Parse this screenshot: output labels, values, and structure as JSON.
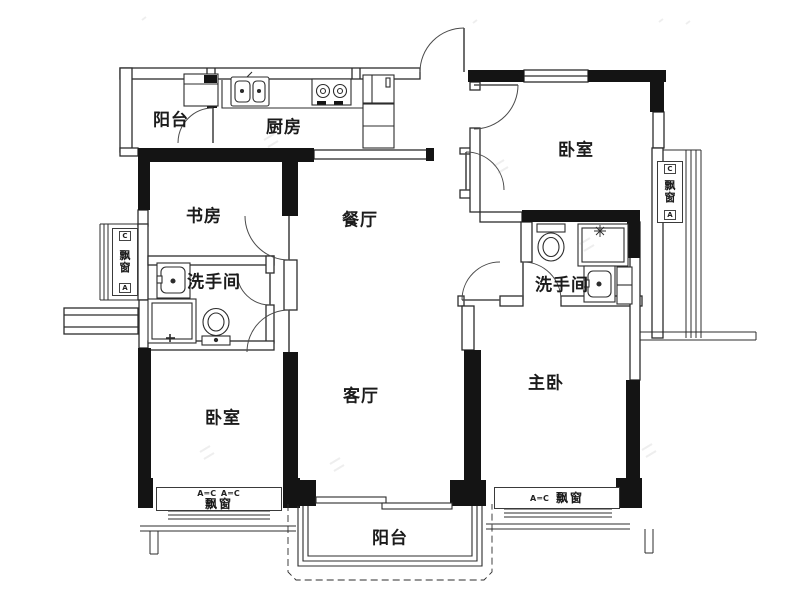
{
  "rooms": {
    "balcony_top": {
      "label": "阳台"
    },
    "kitchen": {
      "label": "厨房"
    },
    "bedroom_top_right": {
      "label": "卧室"
    },
    "study": {
      "label": "书房"
    },
    "dining": {
      "label": "餐厅"
    },
    "bathroom_left": {
      "label": "洗手间"
    },
    "bathroom_right": {
      "label": "洗手间"
    },
    "living": {
      "label": "客厅"
    },
    "bedroom_bottom_left": {
      "label": "卧室"
    },
    "master_bedroom": {
      "label": "主卧"
    },
    "balcony_bottom": {
      "label": "阳台"
    }
  },
  "bay_windows": {
    "left": {
      "label": "飘窗",
      "top_marker": "C",
      "bottom_marker": "A"
    },
    "right": {
      "label": "飘窗",
      "top_marker": "C",
      "bottom_marker": "A"
    },
    "bottom_left": {
      "markers": "A═C A═C",
      "label": "飘窗"
    },
    "bottom_right": {
      "markers": "A═C",
      "label": "飘窗"
    }
  },
  "colors": {
    "wall": "#141414",
    "line": "#2c2c2c",
    "background": "#ffffff"
  }
}
